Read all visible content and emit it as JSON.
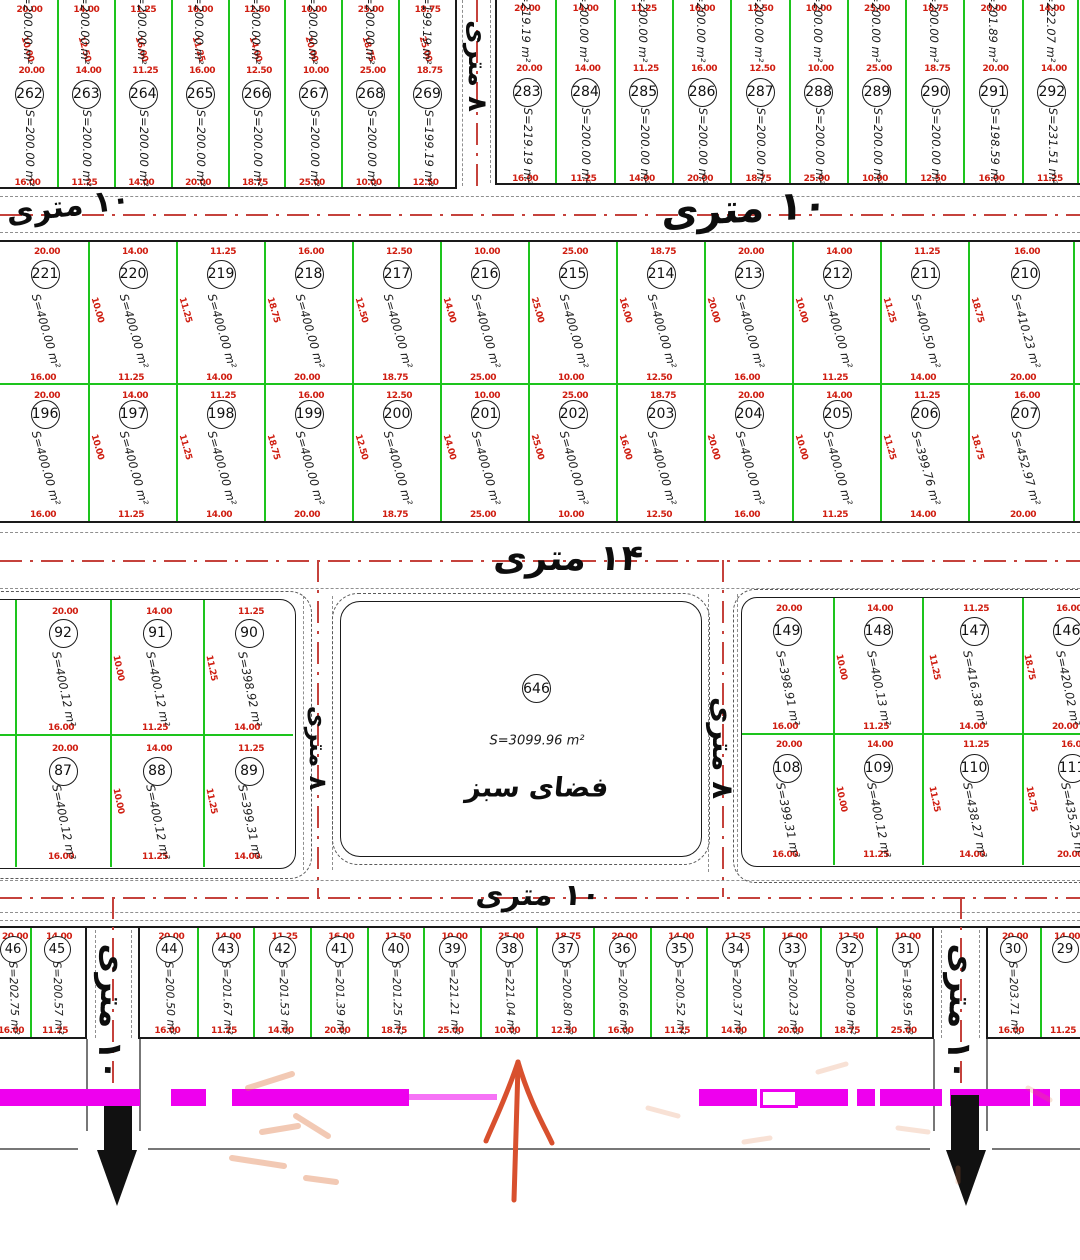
{
  "green_space": {
    "number": "646",
    "area": "S=3099.96 m²",
    "label": "فضای سبز"
  },
  "streets": {
    "h10": "۱۰ متری",
    "h14": "۱۴ متری",
    "v8": "۸ متری",
    "v10": "۱۰ متری"
  },
  "red_dims_samples": [
    "10.00",
    "20.00",
    "16.00",
    "25.00",
    "14.00",
    "12.50",
    "18.75",
    "11.25"
  ],
  "colors": {
    "parcel_green": "#1dc41d",
    "dim_red": "#cf1d10",
    "magenta": "#ee00ee",
    "centerline_red": "#c5423c",
    "arrow_black": "#111111",
    "arrow_orange": "#d8502e"
  },
  "rows": {
    "top_left_partial": [
      "S=200.00 m²",
      "S=200.00 m²",
      "S=200.00 m²",
      "S=200.00 m²",
      "S=200.00 m²",
      "S=200.00 m²",
      "S=200.00 m²",
      "S=199.19 m²"
    ],
    "top_right_partial": [
      "S=219.19 m²",
      "S=200.00 m²",
      "S=200.00 m²",
      "S=200.00 m²",
      "S=200.00 m²",
      "S=200.00 m²",
      "S=200.00 m²",
      "S=200.00 m²",
      "S=201.89 m²",
      "S=222.07 m²"
    ],
    "top_left": [
      {
        "n": "262",
        "a": "S=200.00 m²"
      },
      {
        "n": "263",
        "a": "S=200.00 m²"
      },
      {
        "n": "264",
        "a": "S=200.00 m²"
      },
      {
        "n": "265",
        "a": "S=200.00 m²"
      },
      {
        "n": "266",
        "a": "S=200.00 m²"
      },
      {
        "n": "267",
        "a": "S=200.00 m²"
      },
      {
        "n": "268",
        "a": "S=200.00 m²"
      },
      {
        "n": "269",
        "a": "S=199.19 m²"
      }
    ],
    "top_right": [
      {
        "n": "283",
        "a": "S=219.19 m²"
      },
      {
        "n": "284",
        "a": "S=200.00 m²"
      },
      {
        "n": "285",
        "a": "S=200.00 m²"
      },
      {
        "n": "286",
        "a": "S=200.00 m²"
      },
      {
        "n": "287",
        "a": "S=200.00 m²"
      },
      {
        "n": "288",
        "a": "S=200.00 m²"
      },
      {
        "n": "289",
        "a": "S=200.00 m²"
      },
      {
        "n": "290",
        "a": "S=200.00 m²"
      },
      {
        "n": "291",
        "a": "S=198.59 m²"
      },
      {
        "n": "292",
        "a": "S=231.51 m²"
      }
    ],
    "mid_row1": [
      {
        "n": "221",
        "a": "S=400.00 m²"
      },
      {
        "n": "220",
        "a": "S=400.00 m²"
      },
      {
        "n": "219",
        "a": "S=400.00 m²"
      },
      {
        "n": "218",
        "a": "S=400.00 m²"
      },
      {
        "n": "217",
        "a": "S=400.00 m²"
      },
      {
        "n": "216",
        "a": "S=400.00 m²"
      },
      {
        "n": "215",
        "a": "S=400.00 m²"
      },
      {
        "n": "214",
        "a": "S=400.00 m²"
      },
      {
        "n": "213",
        "a": "S=400.00 m²"
      },
      {
        "n": "212",
        "a": "S=400.00 m²"
      },
      {
        "n": "211",
        "a": "S=400.50 m²"
      },
      {
        "n": "210",
        "a": "S=410.23 m²"
      }
    ],
    "mid_row2": [
      {
        "n": "196",
        "a": "S=400.00 m²"
      },
      {
        "n": "197",
        "a": "S=400.00 m²"
      },
      {
        "n": "198",
        "a": "S=400.00 m²"
      },
      {
        "n": "199",
        "a": "S=400.00 m²"
      },
      {
        "n": "200",
        "a": "S=400.00 m²"
      },
      {
        "n": "201",
        "a": "S=400.00 m²"
      },
      {
        "n": "202",
        "a": "S=400.00 m²"
      },
      {
        "n": "203",
        "a": "S=400.00 m²"
      },
      {
        "n": "204",
        "a": "S=400.00 m²"
      },
      {
        "n": "205",
        "a": "S=400.00 m²"
      },
      {
        "n": "206",
        "a": "S=399.76 m²"
      },
      {
        "n": "207",
        "a": "S=452.97 m²"
      }
    ],
    "lower_left_r1": [
      {
        "n": "92",
        "a": "S=400.12 m²"
      },
      {
        "n": "91",
        "a": "S=400.12 m²"
      },
      {
        "n": "90",
        "a": "S=398.92 m²"
      }
    ],
    "lower_left_r2": [
      {
        "n": "87",
        "a": "S=400.12 m²"
      },
      {
        "n": "88",
        "a": "S=400.12 m²"
      },
      {
        "n": "89",
        "a": "S=399.31 m²"
      }
    ],
    "lower_right_r1": [
      {
        "n": "149",
        "a": "S=398.91 m²"
      },
      {
        "n": "148",
        "a": "S=400.13 m²"
      },
      {
        "n": "147",
        "a": "S=416.38 m²"
      },
      {
        "n": "146",
        "a": "S=420.02 m²"
      }
    ],
    "lower_right_r2": [
      {
        "n": "108",
        "a": "S=399.31 m²"
      },
      {
        "n": "109",
        "a": "S=400.12 m²"
      },
      {
        "n": "110",
        "a": "S=438.27 m²"
      },
      {
        "n": "111",
        "a": "S=435.25 m²"
      }
    ],
    "bottom_left": [
      {
        "n": "46",
        "a": "S=202.75 m²"
      },
      {
        "n": "45",
        "a": "S=200.57 m²"
      }
    ],
    "bottom_main": [
      {
        "n": "44",
        "a": "S=200.50 m²"
      },
      {
        "n": "43",
        "a": "S=201.67 m²"
      },
      {
        "n": "42",
        "a": "S=201.53 m²"
      },
      {
        "n": "41",
        "a": "S=201.39 m²"
      },
      {
        "n": "40",
        "a": "S=201.25 m²"
      },
      {
        "n": "39",
        "a": "S=221.21 m²"
      },
      {
        "n": "38",
        "a": "S=221.04 m²"
      },
      {
        "n": "37",
        "a": "S=200.80 m²"
      },
      {
        "n": "36",
        "a": "S=200.66 m²"
      },
      {
        "n": "35",
        "a": "S=200.52 m²"
      },
      {
        "n": "34",
        "a": "S=200.37 m²"
      },
      {
        "n": "33",
        "a": "S=200.23 m²"
      },
      {
        "n": "32",
        "a": "S=200.09 m²"
      },
      {
        "n": "31",
        "a": "S=198.95 m²"
      }
    ],
    "bottom_right": [
      {
        "n": "30",
        "a": "S=203.71 m²"
      },
      {
        "n": "29",
        "a": ""
      }
    ]
  }
}
